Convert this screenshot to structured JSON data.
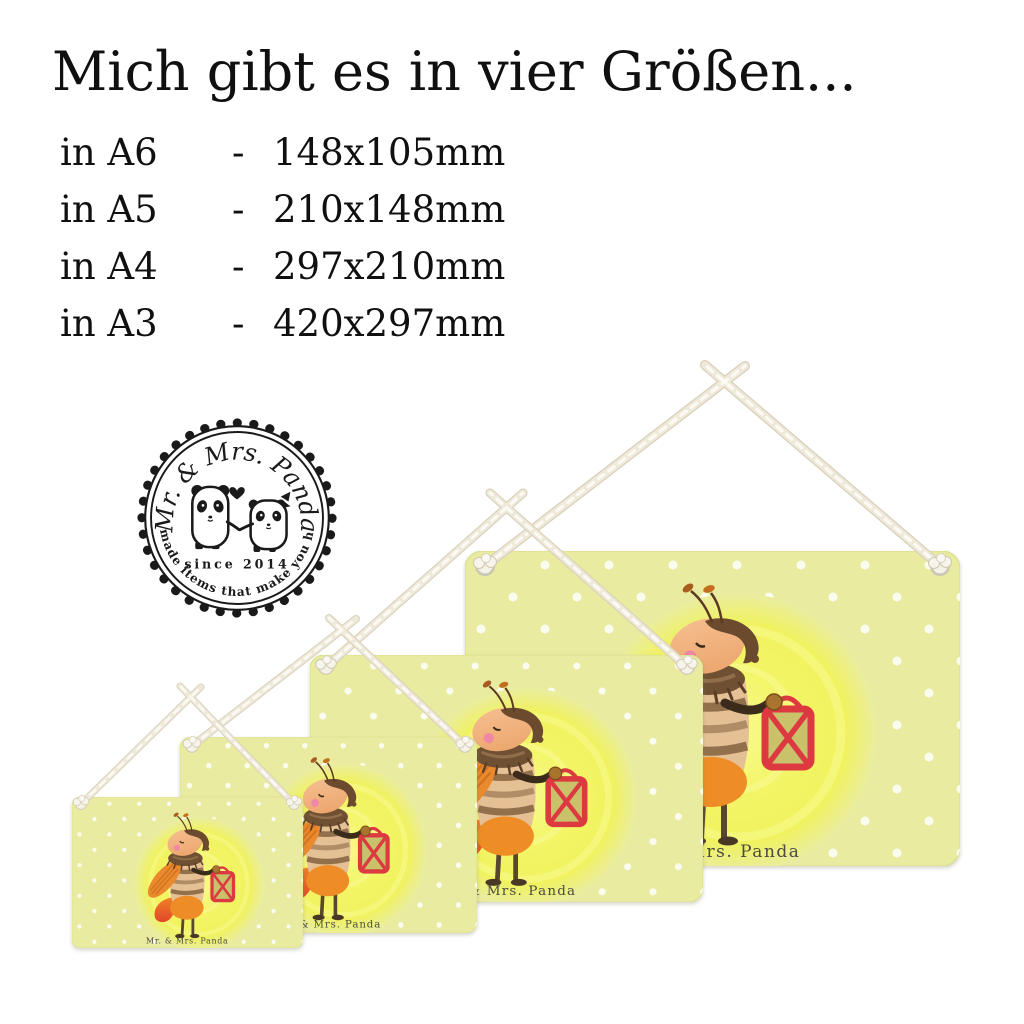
{
  "heading": {
    "text": "Mich gibt es in vier Größen..."
  },
  "size_list": {
    "separator": "-",
    "items": [
      {
        "format": "in A6",
        "dimensions": "148x105mm"
      },
      {
        "format": "in A5",
        "dimensions": "210x148mm"
      },
      {
        "format": "in A4",
        "dimensions": "297x210mm"
      },
      {
        "format": "in A3",
        "dimensions": "420x297mm"
      }
    ]
  },
  "logo": {
    "brand": "Mr. & Mrs. Panda",
    "since": "since 2014",
    "tagline": "Handmade items that make you happy!"
  },
  "signs": {
    "watermark": "Mr. & Mrs. Panda"
  },
  "colors": {
    "background": "#ffffff",
    "heading_text": "#101010",
    "sign_background": "#e9eba0",
    "polka_dot": "#fbfcf0",
    "moon_yellow": "#f3f567",
    "rope": "#efe9da",
    "rope_shadow": "#d8d0ba",
    "lantern_red": "#dc3a40",
    "firefly_orange": "#ee8c25",
    "firefly_brown": "#6f5033",
    "skin_peach": "#f2b183",
    "cheek_pink": "#f083a8",
    "watermark_text": "#4b4a42",
    "logo_ink": "#1a1a1a"
  }
}
